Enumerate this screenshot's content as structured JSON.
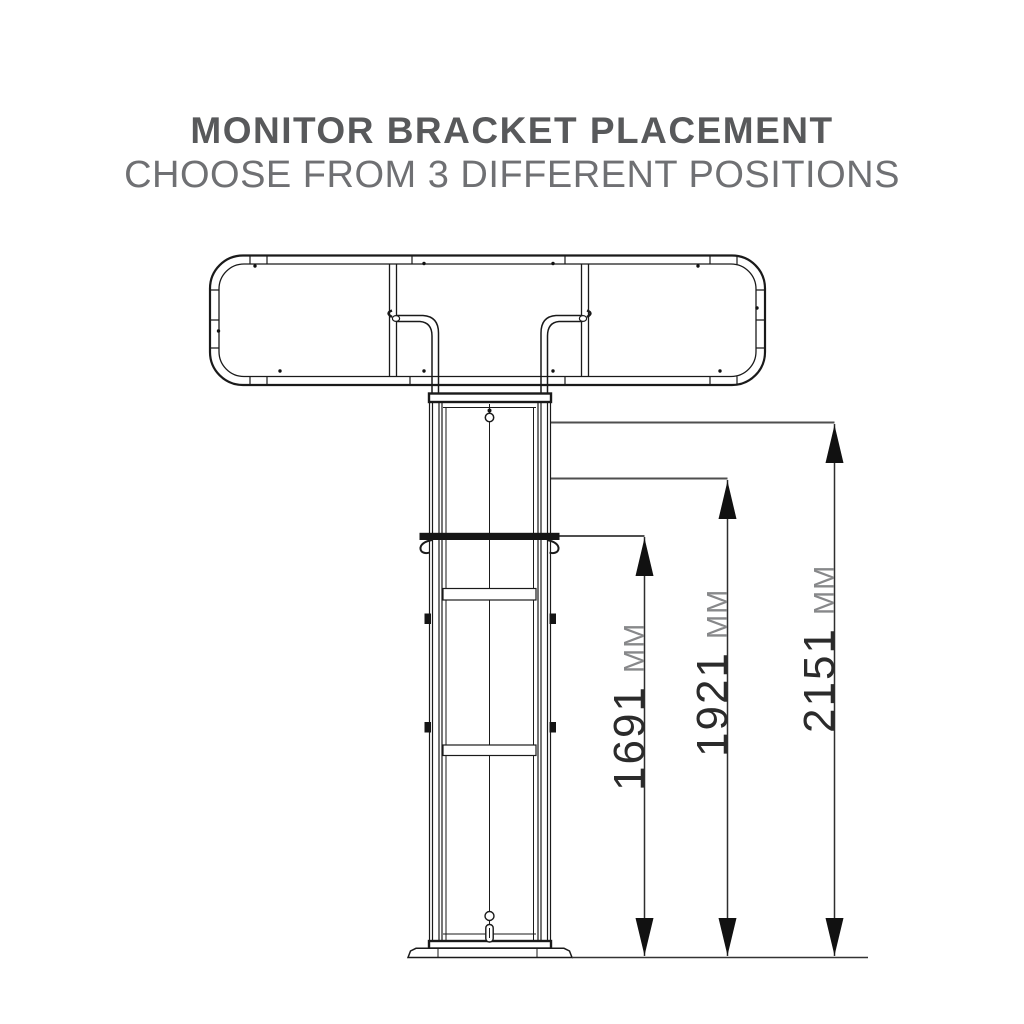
{
  "header": {
    "title": "MONITOR BRACKET PLACEMENT",
    "subtitle": "CHOOSE FROM 3 DIFFERENT POSITIONS",
    "title_color": "#58595b",
    "subtitle_color": "#6f7073"
  },
  "diagram": {
    "type": "technical-drawing",
    "bracket_position_count": "3",
    "dimensions": [
      {
        "value": "1691",
        "unit": "MM"
      },
      {
        "value": "1921",
        "unit": "MM"
      },
      {
        "value": "2151",
        "unit": "MM"
      }
    ],
    "colors": {
      "line": "#1a1a1a",
      "leader": "#4f4f4f",
      "dimension_number": "#2b2b2b",
      "dimension_unit": "#87888a",
      "arrow": "#111111"
    }
  }
}
